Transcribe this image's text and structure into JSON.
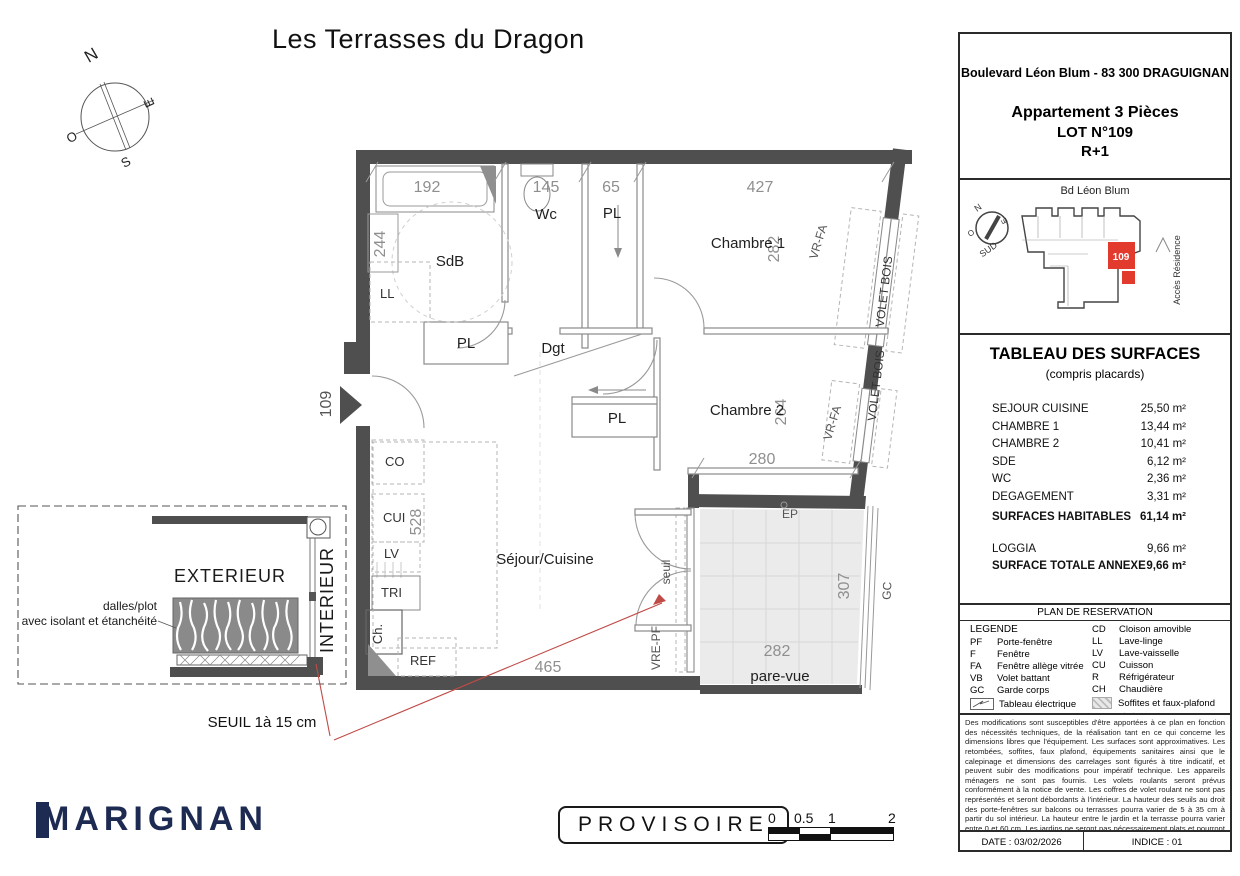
{
  "title": "Les Terrasses du Dragon",
  "compass": {
    "n": "N",
    "e": "E",
    "s": "S",
    "o": "O"
  },
  "plan": {
    "rooms": {
      "sdb": "SdB",
      "wc": "Wc",
      "dgt": "Dgt",
      "chambre1": "Chambre 1",
      "chambre2": "Chambre 2",
      "sejour": "Séjour/Cuisine",
      "pl": "PL"
    },
    "dims": {
      "d192": "192",
      "d145": "145",
      "d65": "65",
      "d427": "427",
      "d244": "244",
      "d282": "282",
      "d264": "264",
      "d280": "280",
      "d528": "528",
      "d465": "465",
      "d307": "307",
      "d282b": "282"
    },
    "labels": {
      "ll": "LL",
      "co": "CO",
      "cui": "CUI",
      "lv": "LV",
      "tri": "TRI",
      "ch": "Ch.",
      "ref": "REF",
      "ep": "EP",
      "gc": "GC",
      "seuil": "seuil",
      "vrepf": "VRE-PF",
      "parevue": "pare-vue",
      "vrfa": "VR-FA",
      "voletbois": "VOLET BOIS",
      "lot": "109"
    },
    "annotations": {
      "seuil_note": "SEUIL 1à 15 cm"
    }
  },
  "detail": {
    "exterieur": "EXTERIEUR",
    "interieur": "INTERIEUR",
    "dalles": "dalles/plot",
    "isolant": "avec isolant et étanchéité"
  },
  "footer_left": {
    "logo_m": "M",
    "logo_rest": "ARIGNAN",
    "stamp": "PROVISOIRE",
    "scale": {
      "l0": "0",
      "l05": "0.5",
      "l1": "1",
      "l2": "2"
    }
  },
  "panel": {
    "address": "Boulevard Léon Blum - 83 300 DRAGUIGNAN",
    "apt_type": "Appartement 3 Pièces",
    "lot": "LOT N°109",
    "floor": "R+1",
    "minimap": {
      "street": "Bd Léon Blum",
      "unit": "109",
      "acces": "Accès Résidence",
      "sud": "SUD",
      "n": "N",
      "e": "E",
      "o": "O"
    },
    "surfaces": {
      "title": "TABLEAU DES SURFACES",
      "subtitle": "(compris placards)",
      "rows": [
        {
          "label": "SEJOUR CUISINE",
          "value": "25,50 m²"
        },
        {
          "label": "CHAMBRE 1",
          "value": "13,44 m²"
        },
        {
          "label": "CHAMBRE 2",
          "value": "10,41 m²"
        },
        {
          "label": "SDE",
          "value": "6,12 m²"
        },
        {
          "label": "WC",
          "value": "2,36 m²"
        },
        {
          "label": "DEGAGEMENT",
          "value": "3,31 m²"
        }
      ],
      "total_label": "SURFACES HABITABLES",
      "total_value": "61,14 m²",
      "loggia_label": "LOGGIA",
      "loggia_value": "9,66 m²",
      "annexe_label": "SURFACE TOTALE ANNEXE",
      "annexe_value": "9,66 m²"
    },
    "reservation": {
      "title": "PLAN DE RESERVATION",
      "legend_title": "LEGENDE",
      "col1": [
        {
          "abbr": "PF",
          "label": "Porte-fenêtre"
        },
        {
          "abbr": "F",
          "label": "Fenêtre"
        },
        {
          "abbr": "FA",
          "label": "Fenêtre allège vitrée"
        },
        {
          "abbr": "VB",
          "label": "Volet battant"
        },
        {
          "abbr": "GC",
          "label": "Garde corps"
        }
      ],
      "col2": [
        {
          "abbr": "CD",
          "label": "Cloison amovible"
        },
        {
          "abbr": "LL",
          "label": "Lave-linge"
        },
        {
          "abbr": "LV",
          "label": "Lave-vaisselle"
        },
        {
          "abbr": "CU",
          "label": "Cuisson"
        },
        {
          "abbr": "R",
          "label": "Réfrigérateur"
        },
        {
          "abbr": "CH",
          "label": "Chaudière"
        }
      ],
      "tableau_electrique": "Tableau électrique",
      "soffites": "Soffites et faux-plafond",
      "grillage": "Grillage"
    },
    "disclaimer": "Des modifications sont susceptibles d'être apportées à ce plan en fonction des nécessités techniques, de la réalisation tant en ce qui concerne les dimensions libres que l'équipement. Les surfaces sont approximatives. Les retombées, soffites, faux plafond, équipements sanitaires ainsi que le calepinage et dimensions des carrelages sont figurés à titre indicatif, et peuvent subir des modifications pour impératif technique. Les appareils ménagers ne sont pas fournis.  Les volets roulants seront prévus conformément à la notice de vente. Les coffres de volet roulant ne sont pas représentés et seront débordants à l'intérieur. La hauteur des seuils au droit des porte-fenêtres sur balcons ou terrasses pourra varier de 5 à 35 cm à partir du sol intérieur. La hauteur entre le jardin et la terrasse pourra varier entre 0 et 60 cm. Les jardins ne seront pas nécessairement plats et pourront comporter des talus et des pentes.",
    "footer": {
      "date_label": "DATE : 03/02/2026",
      "indice_label": "INDICE : 01"
    }
  }
}
